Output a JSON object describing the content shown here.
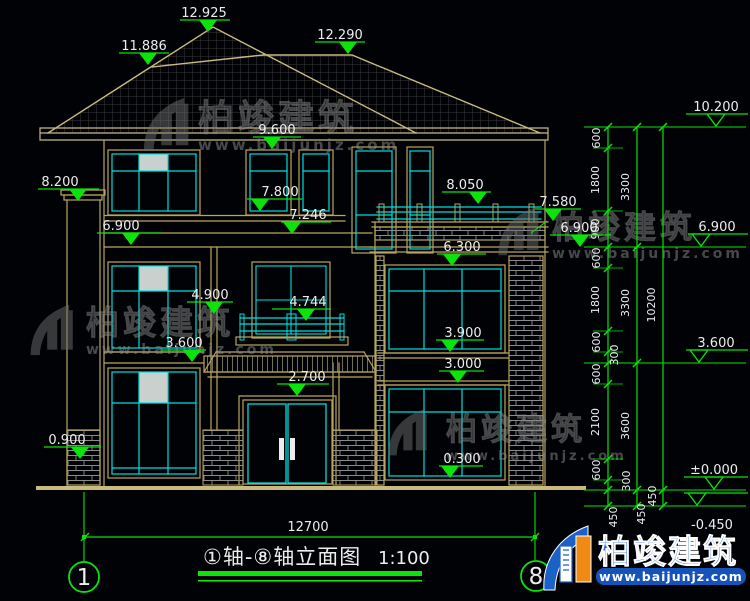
{
  "colors": {
    "background": "#010205",
    "wall_tan": "#b9a55e",
    "roof_tan": "#c9ba80",
    "cyan": "#00dede",
    "green": "#0be30b",
    "text_white": "#ededed",
    "brick_gray": "#8a8a8a",
    "brand_blue": "#1a62c8",
    "brand_orange": "#ef8a15"
  },
  "title": {
    "text": "①轴-⑧轴立面图",
    "scale": "1:100"
  },
  "overall_dim": "12700",
  "axis_left": "1",
  "axis_right": "8",
  "brand": {
    "name": "柏竣建筑",
    "url": "www.baijunjz.com"
  },
  "watermark": {
    "name": "柏竣建筑",
    "url": "www.baijunjz.com",
    "placements": [
      {
        "lx": 140,
        "ly": 95,
        "ls": 58,
        "tx": 198,
        "ty": 130,
        "fs": 36,
        "fs2": 15
      },
      {
        "lx": 27,
        "ly": 302,
        "ls": 55,
        "tx": 86,
        "ty": 334,
        "fs": 33,
        "fs2": 14
      },
      {
        "lx": 495,
        "ly": 205,
        "ls": 52,
        "tx": 552,
        "ty": 238,
        "fs": 32,
        "fs2": 14
      },
      {
        "lx": 385,
        "ly": 407,
        "ls": 50,
        "tx": 446,
        "ty": 440,
        "fs": 31,
        "fs2": 13
      }
    ]
  },
  "level_markers": [
    {
      "label": "12.925",
      "tx": 204,
      "ty": 17,
      "lx1": 180,
      "lx2": 230,
      "ly": 20,
      "cx": 208
    },
    {
      "label": "11.886",
      "tx": 144,
      "ty": 50,
      "lx1": 119,
      "lx2": 169,
      "ly": 53,
      "cx": 148
    },
    {
      "label": "12.290",
      "tx": 340,
      "ty": 39,
      "lx1": 315,
      "lx2": 365,
      "ly": 42,
      "cx": 348
    },
    {
      "label": "9.600",
      "tx": 277,
      "ty": 134,
      "lx1": 253,
      "lx2": 301,
      "ly": 137,
      "cx": 272
    },
    {
      "label": "7.800",
      "tx": 280,
      "ty": 196,
      "lx1": 247,
      "lx2": 302,
      "ly": 199,
      "cx": 260
    },
    {
      "label": "7.246",
      "tx": 308,
      "ty": 219,
      "lx1": 281,
      "lx2": 331,
      "ly": 222,
      "cx": 292
    },
    {
      "label": "8.050",
      "tx": 465,
      "ty": 189,
      "lx1": 442,
      "lx2": 491,
      "ly": 192,
      "cx": 478
    },
    {
      "label": "6.300",
      "tx": 462,
      "ty": 251,
      "lx1": 437,
      "lx2": 486,
      "ly": 254,
      "cx": 452
    },
    {
      "label": "4.900",
      "tx": 210,
      "ty": 299,
      "lx1": 187,
      "lx2": 233,
      "ly": 302,
      "cx": 214
    },
    {
      "label": "4.744",
      "tx": 308,
      "ty": 306,
      "lx1": 272,
      "lx2": 331,
      "ly": 309,
      "cx": 306
    },
    {
      "label": "3.600",
      "tx": 184,
      "ty": 347,
      "lx1": 161,
      "lx2": 206,
      "ly": 350,
      "cx": 192
    },
    {
      "label": "3.900",
      "tx": 463,
      "ty": 337,
      "lx1": 436,
      "lx2": 484,
      "ly": 340,
      "cx": 450
    },
    {
      "label": "3.000",
      "tx": 463,
      "ty": 368,
      "lx1": 439,
      "lx2": 484,
      "ly": 371,
      "cx": 458
    },
    {
      "label": "2.700",
      "tx": 307,
      "ty": 381,
      "lx1": 277,
      "lx2": 329,
      "ly": 384,
      "cx": 297
    },
    {
      "label": "0.300",
      "tx": 462,
      "ty": 463,
      "lx1": 439,
      "lx2": 483,
      "ly": 466,
      "cx": 450
    },
    {
      "label": "8.200",
      "tx": 60,
      "ty": 186,
      "lx1": 38,
      "lx2": 99,
      "ly": 189,
      "cx": 78
    },
    {
      "label": "0.900",
      "tx": 67,
      "ty": 444,
      "lx1": 44,
      "lx2": 101,
      "ly": 447,
      "cx": 80
    },
    {
      "label": "6.900",
      "tx": 121,
      "ty": 230,
      "lx1": 97,
      "lx2": 161,
      "ly": 233,
      "cx": 131
    },
    {
      "label": "6.900",
      "tx": 579,
      "ty": 232,
      "lx1": 550,
      "lx2": 611,
      "ly": 235,
      "cx": 580
    },
    {
      "label": "7.580",
      "tx": 558,
      "ty": 206,
      "lx1": 535,
      "lx2": 581,
      "ly": 209,
      "cx": 553,
      "leader": [
        547,
        221,
        531,
        233
      ]
    },
    {
      "label": "10.200",
      "tx": 716,
      "ty": 111,
      "lx1": 686,
      "lx2": 748,
      "ly": 114,
      "cx": 716,
      "open": true
    },
    {
      "label": "6.900",
      "tx": 717,
      "ty": 231,
      "lx1": 688,
      "lx2": 748,
      "ly": 234,
      "cx": 701,
      "open": true
    },
    {
      "label": "3.600",
      "tx": 716,
      "ty": 347,
      "lx1": 686,
      "lx2": 748,
      "ly": 350,
      "cx": 699,
      "open": true
    },
    {
      "label": "±0.000",
      "tx": 714,
      "ty": 474,
      "lx1": 684,
      "lx2": 748,
      "ly": 477,
      "cx": 714,
      "open": true
    },
    {
      "label": "-0.450",
      "tx": 712,
      "ty": 529,
      "lx1": 684,
      "lx2": 748,
      "ly": 493,
      "cx": 697,
      "open": true
    }
  ],
  "dim_labels": [
    {
      "t": "600",
      "x": 600,
      "y": 138
    },
    {
      "t": "1800",
      "x": 599,
      "y": 180
    },
    {
      "t": "900",
      "x": 599,
      "y": 229
    },
    {
      "t": "600",
      "x": 600,
      "y": 258
    },
    {
      "t": "1800",
      "x": 599,
      "y": 300
    },
    {
      "t": "600",
      "x": 600,
      "y": 342
    },
    {
      "t": "300",
      "x": 618,
      "y": 355
    },
    {
      "t": "600",
      "x": 600,
      "y": 374
    },
    {
      "t": "2100",
      "x": 599,
      "y": 422
    },
    {
      "t": "600",
      "x": 600,
      "y": 470
    },
    {
      "t": "300",
      "x": 630,
      "y": 481
    },
    {
      "t": "450",
      "x": 617,
      "y": 517
    },
    {
      "t": "3300",
      "x": 629,
      "y": 187
    },
    {
      "t": "3300",
      "x": 629,
      "y": 303
    },
    {
      "t": "3600",
      "x": 629,
      "y": 426
    },
    {
      "t": "450",
      "x": 645,
      "y": 514
    },
    {
      "t": "10200",
      "x": 655,
      "y": 305
    },
    {
      "t": "450",
      "x": 656,
      "y": 496
    }
  ],
  "chains": [
    {
      "x": 608,
      "c1": 593,
      "c2": 623,
      "ticks": [
        127,
        148,
        211,
        247,
        268,
        331,
        352,
        363,
        384,
        459,
        480,
        490,
        506
      ]
    },
    {
      "x": 637,
      "c1": 622,
      "c2": 652,
      "ticks": [
        127,
        247,
        363,
        490,
        506
      ]
    },
    {
      "x": 663,
      "c1": 648,
      "c2": 678,
      "ticks": [
        127,
        490,
        506
      ]
    }
  ],
  "major_levels": [
    127,
    247,
    363,
    490,
    506
  ]
}
